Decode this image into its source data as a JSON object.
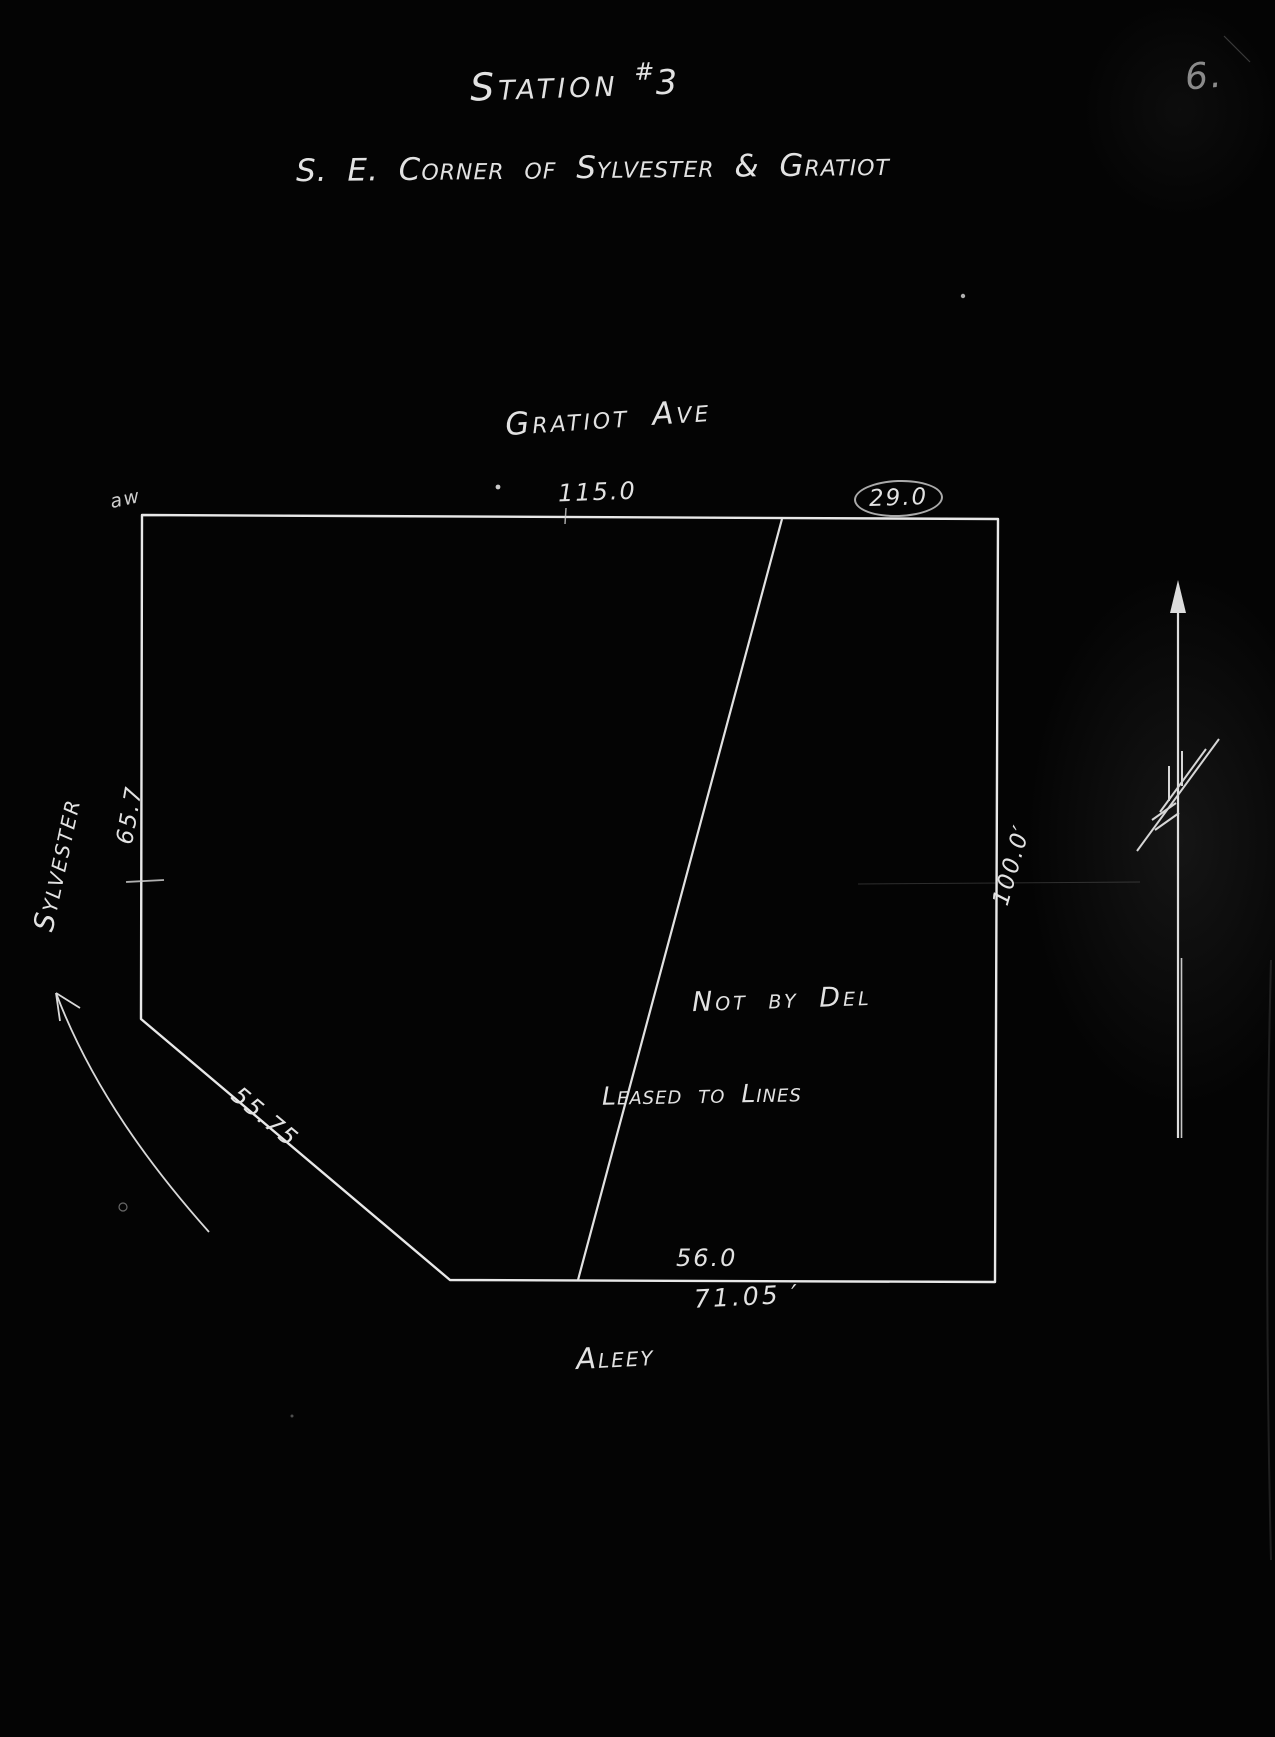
{
  "page": {
    "number": "6."
  },
  "title": {
    "station": "Station",
    "hash": "#",
    "number": "3",
    "subtitle": "S. E. Corner of Sylvester & Gratiot"
  },
  "streets": {
    "top": "Gratiot Ave",
    "left": "Sylvester",
    "bottom": "Aleey"
  },
  "dimensions": {
    "gratiot_frontage": "115.0",
    "gratiot_remainder": "29.0",
    "sylvester_side": "65.7",
    "east_side": "100.0′",
    "chamfer": "55.75",
    "alley_inner": "56.0",
    "alley_total": "71.05 ′"
  },
  "notes": {
    "line1": "Not by Del",
    "line2": "Leased to Lines"
  },
  "marks": {
    "corner_scribble": "aw"
  },
  "colors": {
    "background": "#040404",
    "ink": "#e6e6e6",
    "dim_ink": "#8b8b8b"
  }
}
